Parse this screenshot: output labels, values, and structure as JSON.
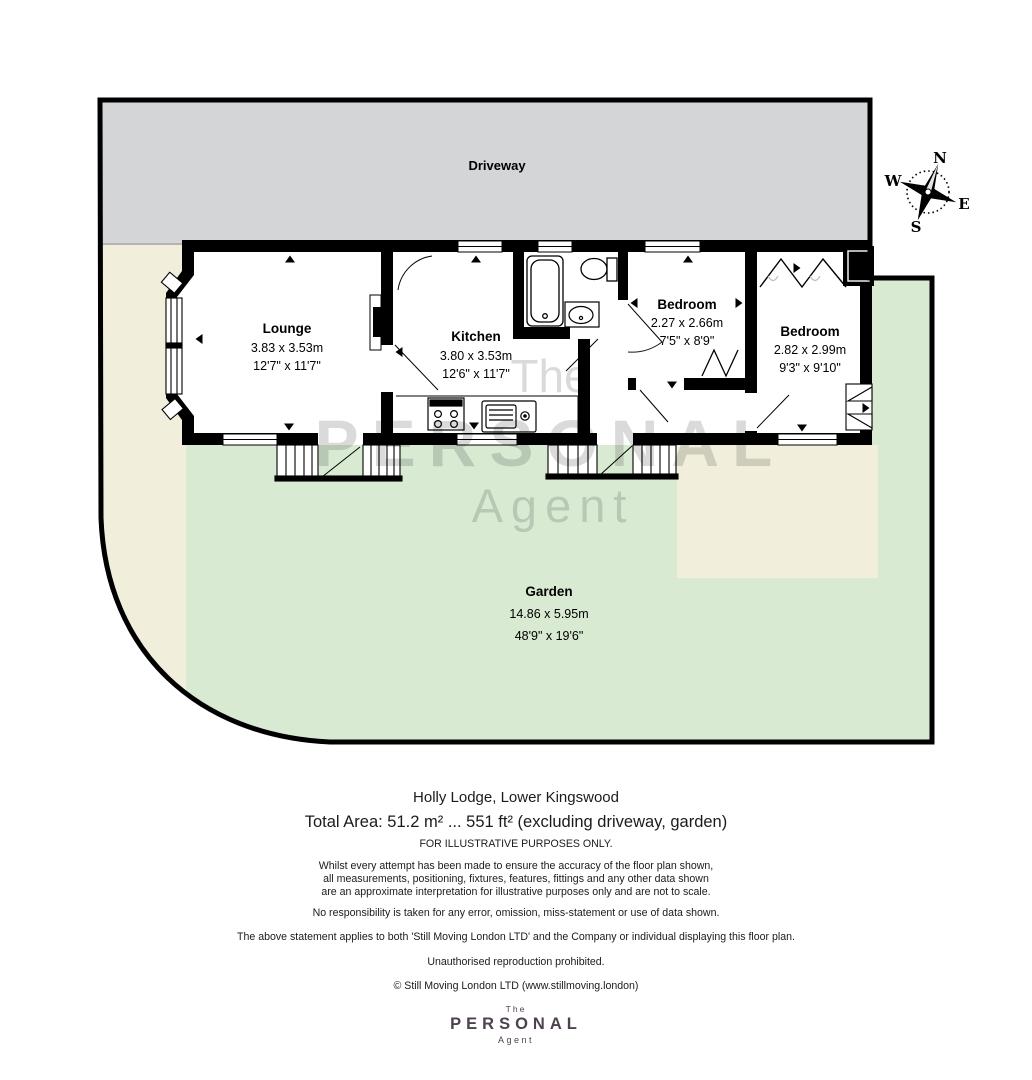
{
  "plan": {
    "driveway_label": "Driveway",
    "compass": {
      "n": "N",
      "e": "E",
      "s": "S",
      "w": "W"
    },
    "rooms": {
      "lounge": {
        "name": "Lounge",
        "metric": "3.83 x 3.53m",
        "imperial": "12'7\" x 11'7\""
      },
      "kitchen": {
        "name": "Kitchen",
        "metric": "3.80 x 3.53m",
        "imperial": "12'6\" x 11'7\""
      },
      "bedroom1": {
        "name": "Bedroom",
        "metric": "2.27 x 2.66m",
        "imperial": "7'5\" x 8'9\""
      },
      "bedroom2": {
        "name": "Bedroom",
        "metric": "2.82 x 2.99m",
        "imperial": "9'3\" x 9'10\""
      },
      "garden": {
        "name": "Garden",
        "metric": "14.86 x 5.95m",
        "imperial": "48'9\" x 19'6\""
      }
    },
    "watermark": {
      "top": "The",
      "middle": "PERSONAL",
      "bottom": "Agent"
    },
    "colors": {
      "driveway": "#d4d5d7",
      "garden": "#d9ead3",
      "plot_cream": "#f1efdb",
      "wall": "#000000",
      "watermark": "#d8d8d8",
      "logo": "#4e4150"
    }
  },
  "footer": {
    "address": "Holly Lodge, Lower Kingswood",
    "total_area": "Total Area: 51.2 m² ... 551 ft² (excluding driveway, garden)",
    "illustrative": "FOR ILLUSTRATIVE PURPOSES ONLY.",
    "disclaimer1": "Whilst every attempt has been made to ensure the accuracy of the floor plan shown,",
    "disclaimer2": "all measurements, positioning, fixtures, features, fittings and any other data shown",
    "disclaimer3": "are an approximate interpretation for illustrative purposes only and are not to scale.",
    "responsibility": "No responsibility is taken for any error, omission, miss-statement or use of data shown.",
    "statement": "The above statement applies to both 'Still Moving London LTD' and the Company or individual displaying this floor plan.",
    "reproduction": "Unauthorised reproduction prohibited.",
    "copyright": "© Still Moving London LTD (www.stillmoving.london)",
    "logo": {
      "top": "The",
      "middle": "PERSONAL",
      "bottom": "Agent"
    }
  }
}
